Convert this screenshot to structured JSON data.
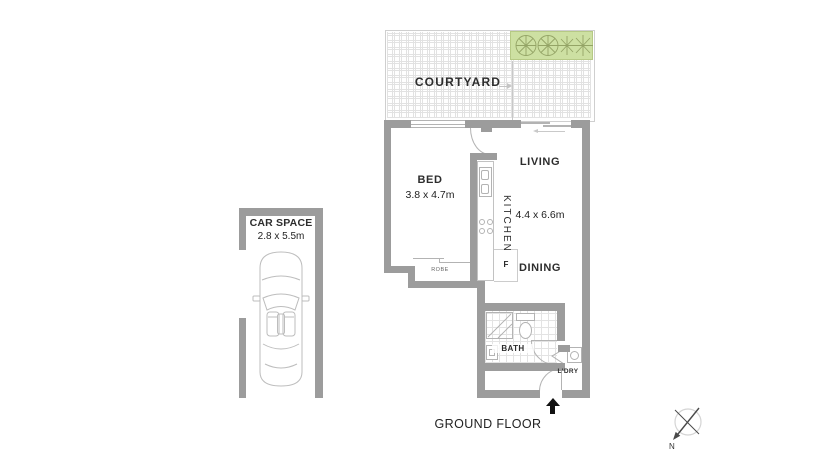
{
  "floor_label": "GROUND FLOOR",
  "courtyard": {
    "label": "COURTYARD"
  },
  "car_space": {
    "label": "CAR SPACE",
    "dimensions": "2.8 x 5.5m"
  },
  "rooms": {
    "bed": {
      "label": "BED",
      "dimensions": "3.8 x 4.7m"
    },
    "kitchen": {
      "label": "KITCHEN"
    },
    "living": {
      "label": "LIVING"
    },
    "living_dining": {
      "dimensions": "4.4 x 6.6m"
    },
    "dining": {
      "label": "DINING"
    },
    "bath": {
      "label": "BATH"
    },
    "laundry": {
      "label": "L'DRY"
    },
    "robe": {
      "label": "ROBE"
    },
    "fridge": {
      "label": "F"
    }
  },
  "compass": {
    "north": "N"
  },
  "colors": {
    "wall": "#9c9c9c",
    "line": "#b3b3b3",
    "gardenFill": "#cde0a2",
    "gardenStroke": "#b6c985",
    "plant": "#94a466",
    "text": "#2d2d2d",
    "arrow": "#111111"
  }
}
